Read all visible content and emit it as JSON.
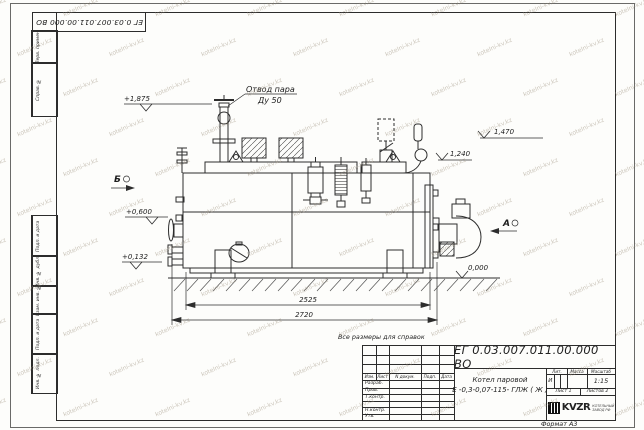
{
  "page": {
    "format_label": "Формат А3",
    "reference_note": "Все размеры для справок"
  },
  "watermark": {
    "text": "kotelni-kv.kz"
  },
  "margin_labels": [
    "Перв. примен.",
    "Справ. №",
    "Подп. и дата",
    "Инв. № дубл.",
    "Взам. инв. №",
    "Подп. и дата",
    "Инв. № подл."
  ],
  "drawing": {
    "labels": {
      "steam_outlet_line1": "Отвод пара",
      "steam_outlet_line2": "Ду 50",
      "view_a": "А",
      "view_b": "Б"
    },
    "elevations": {
      "e1875": "+1,875",
      "e0600": "+0,600",
      "e0132": "+0,132",
      "e1470": "1,470",
      "e1240": "1,240",
      "e0000": "0,000"
    },
    "dimensions": {
      "d2525": "2525",
      "d2720": "2720"
    }
  },
  "title_block": {
    "doc_number": "ЕГ 0.03.007.011.00.000  ВО",
    "product_name_line1": "Котел паровой",
    "product_name_line2": "Е -0,3-0,07-115- ГЛЖ ( Ж )",
    "columns": {
      "izm": "Изм.",
      "list": "Лист",
      "ndoc": "N докум.",
      "podp": "Подп.",
      "data": "Дата"
    },
    "rows": [
      "Разраб.",
      "Пров.",
      "Т.контр.",
      "",
      "Н.контр.",
      "Утв."
    ],
    "lit_label": "Лит.",
    "mass_label": "Масса",
    "scale_label": "Масштаб",
    "lit_value": "И",
    "scale_value": "1:15",
    "sheet_text": "Лист 1",
    "sheets_text": "Листов 2",
    "company_logo": "KVZR",
    "company_line1": "КОТЕЛЬНЫЙ",
    "company_line2": "ЗАВОД РФ"
  }
}
